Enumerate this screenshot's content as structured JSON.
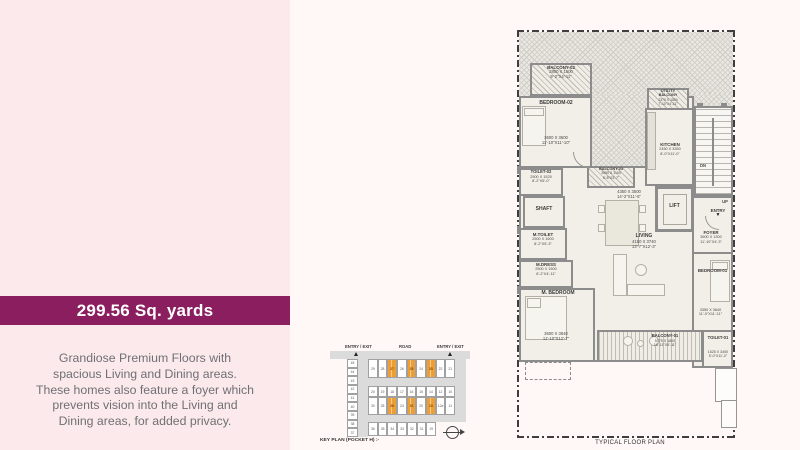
{
  "colors": {
    "banner": "#8a1e5f",
    "panel_bg": "#fbe9ec",
    "page_bg": "#fff8f7",
    "accent_orange": "#ee9e33"
  },
  "info_panel": {
    "area_label": "299.56 Sq. yards",
    "description_lines": [
      "Grandiose Premium Floors with",
      "spacious Living and Dining areas.",
      "These homes also feature a foyer which",
      "prevents vision into the Living and",
      "Dining areas, for added privacy."
    ]
  },
  "key_plan": {
    "caption": "KEY PLAN (POCKET H) :-",
    "top_labels": {
      "left": "ENTRY / EXIT",
      "center": "ROAD",
      "right": "ENTRY / EXIT"
    },
    "left_column": {
      "cells": [
        "45",
        "44",
        "43",
        "42",
        "41",
        "40",
        "39",
        "38",
        "37"
      ],
      "orange": []
    },
    "rows": [
      {
        "cells": [
          "29",
          "28",
          "27",
          "26",
          "25",
          "24",
          "23",
          "22",
          "21"
        ],
        "orange": [
          2,
          4,
          6
        ]
      },
      {
        "cells": [
          "20",
          "19",
          "18",
          "17",
          "16",
          "15",
          "14",
          "12",
          "10"
        ],
        "orange": []
      },
      {
        "cells": [
          "30",
          "28",
          "26",
          "24",
          "22",
          "20",
          "13",
          "12a",
          "11"
        ],
        "orange": [
          2,
          4,
          6
        ]
      },
      {
        "cells": [
          "36",
          "35",
          "34",
          "33",
          "32",
          "31",
          "19"
        ],
        "orange": []
      }
    ]
  },
  "floor_plan": {
    "caption": "TYPICAL FLOOR PLAN",
    "labels": {
      "dn": "DN",
      "up": "UP",
      "entry": "ENTRY"
    },
    "rooms": {
      "balcony02": {
        "name": "BALCONY-02",
        "mm": "2800 X 1500",
        "ft": "9'-2\"X4'-11\""
      },
      "bedroom02": {
        "name": "BEDROOM-02",
        "mm": "3600 X 3600",
        "ft": "11'-10\"X11'-10\""
      },
      "toilet02": {
        "name": "TOILET-02",
        "mm": "2500 X 1525",
        "ft": "8'-2\"X5'-0\""
      },
      "shaft": {
        "name": "SHAFT"
      },
      "mtoilet": {
        "name": "M.TOILET",
        "mm": "2500 X 1600",
        "ft": "8'-2\"X5'-3\""
      },
      "mdress": {
        "name": "M.DRESS",
        "mm": "2500 X 1500",
        "ft": "8'-2\"X4'-11\""
      },
      "mbedroom": {
        "name": "M. BEDROOM",
        "mm": "3600 X 3840",
        "ft": "11'-10\"X12'-7\""
      },
      "balcony03": {
        "name": "BALCONY-03",
        "mm": "2650 X 1100",
        "ft": "8'-8\"X3'-7\""
      },
      "dining": {
        "mm": "4350 X 3500",
        "ft": "14'-2\"X11'-6\""
      },
      "kitchen": {
        "name": "KITCHEN",
        "mm": "2450 X 3350",
        "ft": "8'-0\"X11'-0\""
      },
      "utility": {
        "name1": "UTILITY",
        "name2": "BALCONY",
        "mm": "2375 X 1500",
        "ft": "7'-10\"X4'-11\""
      },
      "lift": {
        "name": "LIFT"
      },
      "foyer": {
        "name": "FOYER",
        "mm": "3600 X 1300",
        "ft": "11'-10\"X4'-3\""
      },
      "living": {
        "name": "LIVING",
        "mm": "4150 X 3740",
        "ft": "13'-7\"X12'-3\""
      },
      "bedroom01": {
        "name": "BEDROOM-01",
        "mm": "3350 X 3640",
        "ft": "11'-0\"X11'-11\""
      },
      "balcony01": {
        "name": "BALCONY-01",
        "mm": "5775 X 1800",
        "ft": "18'-11\"X5'-11\""
      },
      "toilet01": {
        "name": "TOILET-01",
        "mm": "1525 X 3400",
        "ft": "5'-0\"X11'-2\""
      }
    }
  }
}
